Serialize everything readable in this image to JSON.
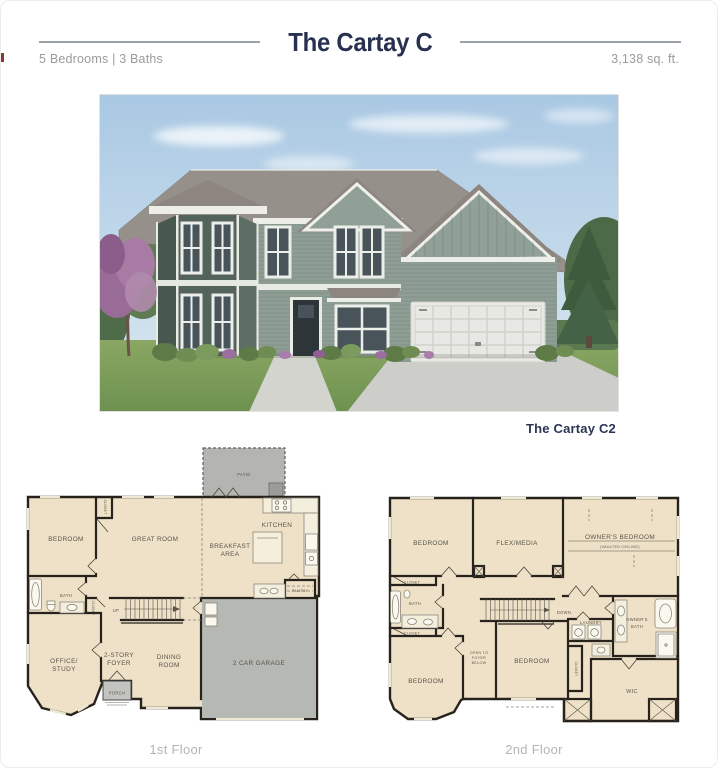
{
  "header": {
    "title": "The Cartay C",
    "beds_baths": "5 Bedrooms | 3 Baths",
    "sqft": "3,138 sq. ft."
  },
  "house": {
    "caption": "The Cartay C2"
  },
  "floor1": {
    "caption": "1st Floor",
    "labels": {
      "patio": "PATIO",
      "bedroom": "BEDROOM",
      "closet_wardrobe": "CLOSET",
      "great_room": "GREAT ROOM",
      "breakfast_area": [
        "BREAKFAST",
        "AREA"
      ],
      "kitchen": "KITCHEN",
      "pantry": "PANTRY",
      "bath": "BATH",
      "closet_understair": "CLOSET",
      "up": "UP",
      "office_study": [
        "OFFICE/",
        "STUDY"
      ],
      "two_story_foyer": [
        "2-STORY",
        "FOYER"
      ],
      "dining_room": [
        "DINING",
        "ROOM"
      ],
      "porch": "PORCH",
      "garage": "2 CAR GARAGE"
    }
  },
  "floor2": {
    "caption": "2nd Floor",
    "labels": {
      "bedroom_top": "BEDROOM",
      "flex_media": "FLEX/MEDIA",
      "owners_bedroom": "OWNER'S BEDROOM",
      "vaulted_ceiling": "(VAULTED CEILING)",
      "closet_top": "CLOSET",
      "bath": "BATH",
      "closet_mid": "CLOSET",
      "bedroom_left": "BEDROOM",
      "open_to_foyer": [
        "OPEN TO",
        "FOYER",
        "BELOW"
      ],
      "bedroom_center": "BEDROOM",
      "down": "DOWN",
      "laundry": "LAUNDRY",
      "owners_bath": [
        "OWNER'S",
        "BATH"
      ],
      "wic": "WIC",
      "closet_vert": "CLOSET"
    }
  },
  "colors": {
    "navy": "#27304f",
    "subtext_gray": "#9b9b9b",
    "caption_gray": "#b4b4b4",
    "plan_floor": "#eee1c7",
    "plan_wall": "#27231c",
    "patio_gray": "#b4b4b1",
    "garage_gray": "#b6b8b4",
    "siding_sage": "#8e9e95",
    "bay_teal": "#53655b",
    "roof_gray": "#96908a"
  }
}
